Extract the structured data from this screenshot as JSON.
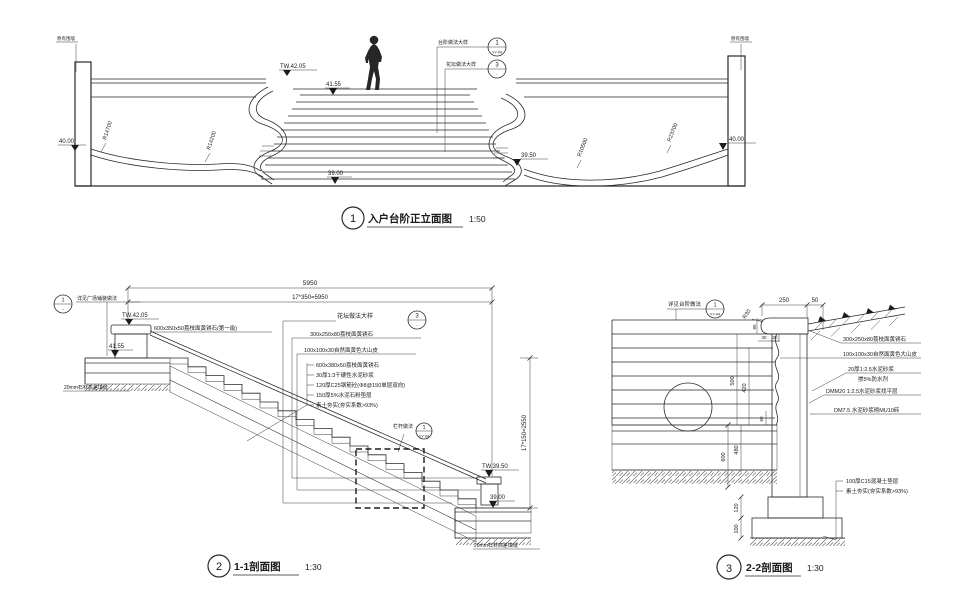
{
  "elevation": {
    "title": {
      "num": "1",
      "text": "入户台阶正立面图",
      "scale": "1:50"
    },
    "walls": {
      "left": "原有围墙",
      "right": "原有围墙"
    },
    "levels": {
      "tw_top": "TW.42.05",
      "top_step": "41.55",
      "ground_left": "40.00",
      "ground_right": "40.00",
      "bottom_right": "39.50",
      "bottom": "39.00"
    },
    "radii": {
      "r1": "R14700",
      "r2": "R14200",
      "r3": "R10500",
      "r4": "R23700"
    },
    "callouts": {
      "step": {
        "text": "台阶做法大样",
        "num": "1",
        "ref": "YY-04"
      },
      "planter": {
        "text": "花坛做法大样",
        "num": "3",
        "ref": "-"
      }
    }
  },
  "section11": {
    "title": {
      "num": "2",
      "text": "1-1剖面图",
      "scale": "1:30"
    },
    "dims": {
      "total": "5950",
      "treads": "17*350=5950",
      "height": "17*150=2550"
    },
    "levels": {
      "tw_top": "TW.42.05",
      "plaza": "41.55",
      "tw_bottom": "TW.39.50",
      "bottom": "39.00"
    },
    "callouts": {
      "paving": {
        "text": "详见广场铺装做法",
        "num": "1",
        "ref": "-"
      },
      "planter": {
        "text": "花坛做法大样",
        "num": "3",
        "ref": "-"
      },
      "railing": {
        "text": "栏杆做法",
        "num": "1",
        "ref": "YY-04"
      }
    },
    "notes": {
      "first_step": "600x350x50荔枝面黄锈石(第一级)",
      "coping": "300x250x80荔枝面黄锈石",
      "rock": "100x100x30自然面黄色大山皮",
      "joint_top": "20mm石材高差填缝",
      "joint_bottom": "20mm石材高差填缝",
      "layers": [
        "600x380x50荔枝面黄锈石",
        "30厚1:3干硬性水泥砂浆",
        "120厚C25钢筋砼(Φ8@150单层双向)",
        "150厚5%水泥石粉垫层",
        "素土夯实(夯实系数>93%)"
      ]
    }
  },
  "section22": {
    "title": {
      "num": "3",
      "text": "2-2剖面图",
      "scale": "1:30"
    },
    "callout": {
      "text": "详见台阶做法",
      "num": "1",
      "ref": "YY-04"
    },
    "dims": {
      "w250": "250",
      "w50": "50",
      "r30": "R30",
      "t80": "80",
      "t30": "30",
      "t20": "20",
      "h500": "500",
      "h420": "420",
      "h60": "60",
      "h600": "600",
      "h480": "480",
      "h120": "120",
      "h100": "100"
    },
    "notes": {
      "coping": "300x250x80荔枝面黄锈石",
      "rock": "100x100x30自然面黄色大山皮",
      "mortar1": "20厚1:2.5水泥砂浆",
      "mortar2": "掺5%防水剂",
      "leveling": "DMM20 1:2.5水泥砂浆找平层",
      "brick": "DM7.5 水泥砂浆砌MU10砖",
      "cushion": "100厚C15混凝土垫层",
      "soil": "素土夯实(夯实系数>93%)"
    }
  }
}
